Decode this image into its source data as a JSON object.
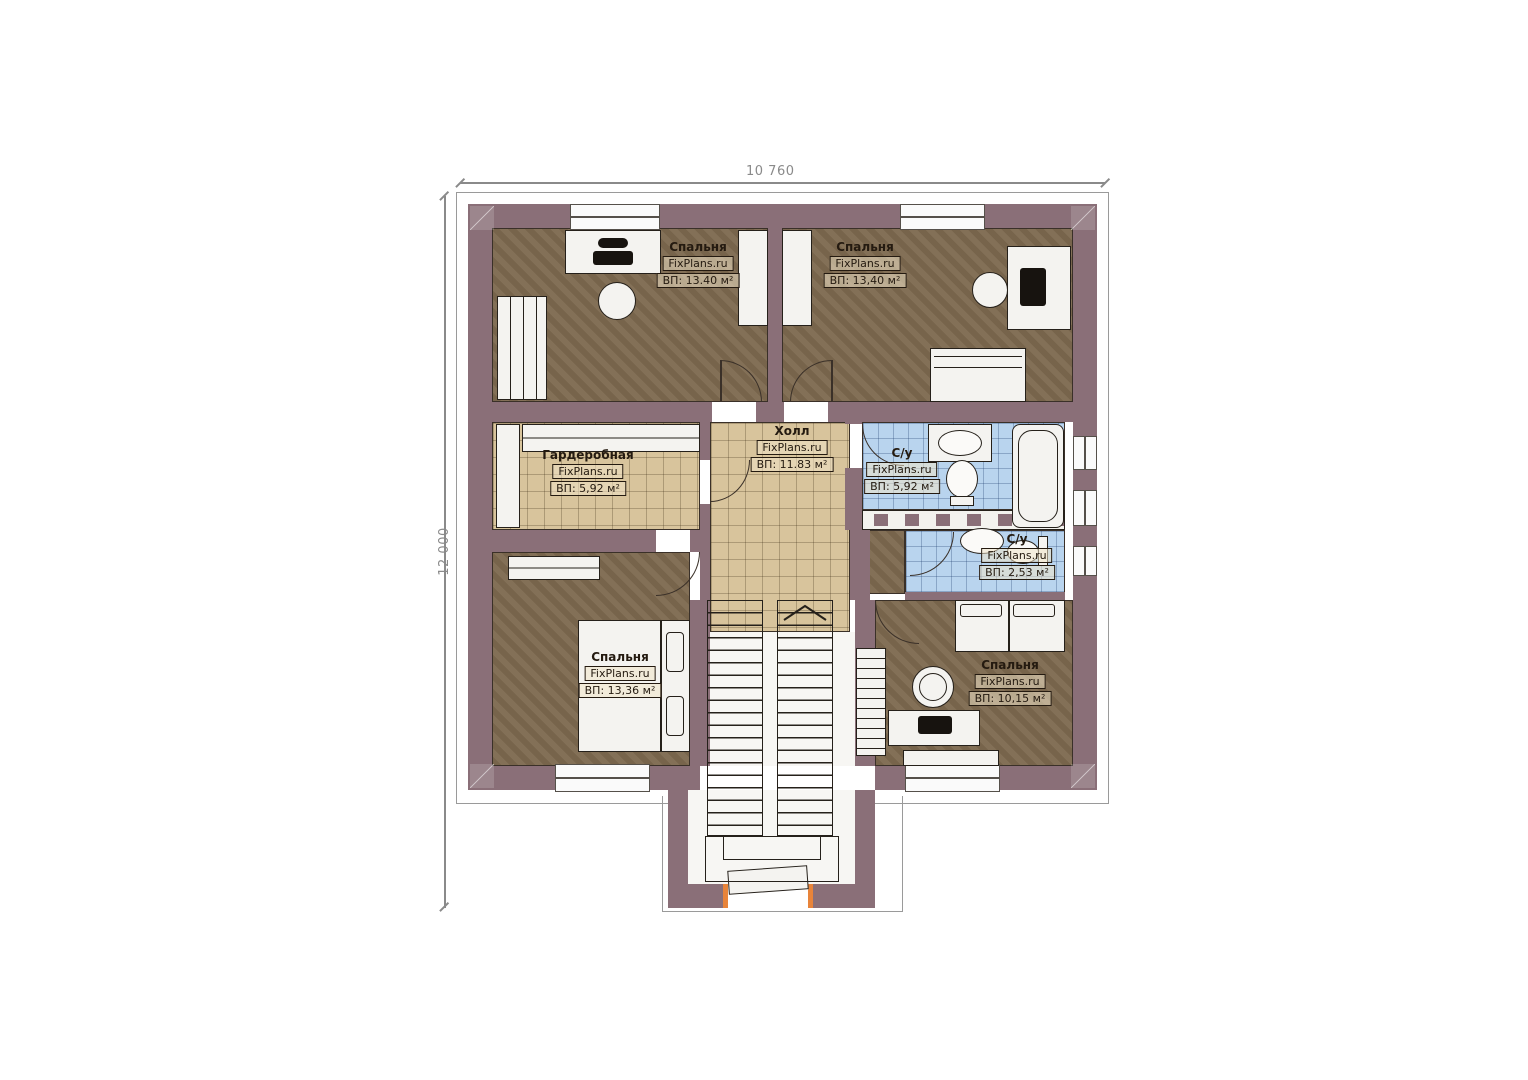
{
  "plan": {
    "title": "floor-plan-second-storey",
    "brand": "FixPlans.ru",
    "dimensions": {
      "top": "10 760",
      "left": "12 000"
    },
    "rooms": [
      {
        "id": "bedroom-top-left",
        "name": "Спальня",
        "area": "ВП: 13.40 м²"
      },
      {
        "id": "bedroom-top-right",
        "name": "Спальня",
        "area": "ВП: 13,40 м²"
      },
      {
        "id": "hall",
        "name": "Холл",
        "area": "ВП: 11.83 м²"
      },
      {
        "id": "wardrobe-room",
        "name": "Гардеробная",
        "area": "ВП: 5,92 м²"
      },
      {
        "id": "bathroom-main",
        "name": "С/у",
        "area": "ВП: 5,92 м²"
      },
      {
        "id": "bathroom-small",
        "name": "С/у",
        "area": "ВП: 2,53 м²"
      },
      {
        "id": "bedroom-bottom-left",
        "name": "Спальня",
        "area": "ВП: 13,36 м²"
      },
      {
        "id": "bedroom-bottom-right",
        "name": "Спальня",
        "area": "ВП: 10,15 м²"
      }
    ],
    "colors": {
      "wall": "#8a6f78",
      "floor_bedroom": "#7e6a50",
      "floor_tile_beige": "#d8c49c",
      "floor_tile_blue": "#b9d4ee",
      "entry_accent": "#e8843a"
    }
  }
}
